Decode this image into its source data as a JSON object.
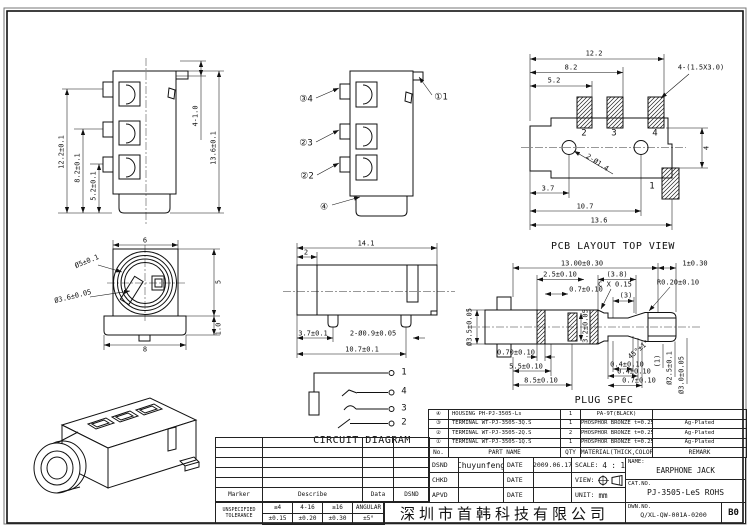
{
  "front_view": {
    "dim_a": "12.2±0.1",
    "dim_b": "8.2±0.1",
    "dim_c": "5.2±0.1",
    "dim_d": "4-1.0",
    "dim_e": "13.6±0.1"
  },
  "callout_view": {
    "c1": "③4",
    "c2": "②3",
    "c3": "②2",
    "c4": "④",
    "c5": "①1"
  },
  "pcb_layout": {
    "title": "PCB LAYOUT TOP VIEW",
    "dim_a": "12.2",
    "dim_b": "8.2",
    "dim_c": "5.2",
    "slot_note": "4-(1.5X3.0)",
    "hole_note": "2-Ø1.4",
    "dim_d": "4",
    "dim_e": "3.7",
    "dim_f": "10.7",
    "dim_g": "13.6",
    "pad_2": "2",
    "pad_3": "3",
    "pad_4": "4",
    "pad_1": "1"
  },
  "front_circle_view": {
    "dia_a": "Ø5±0.1",
    "dia_b": "Ø3.6±0.05",
    "dim_a": "6",
    "dim_b": "5",
    "dim_c": "8",
    "dim_d": "1.0"
  },
  "side_view": {
    "dim_a": "14.1",
    "dim_b": "2",
    "dim_c": "3.7±0.1",
    "pin_note": "2-Ø0.9±0.05",
    "dim_d": "10.7±0.1"
  },
  "plug_spec": {
    "title": "PLUG SPEC",
    "dim_a": "13.00±0.30",
    "dim_b": "1±0.30",
    "dim_c": "2.5±0.10",
    "dim_d": "(3.8)",
    "dim_e": "C X 0.15",
    "dim_f": "0.7±0.10",
    "dim_g": "(3)",
    "dim_h": "R0.20±0.10",
    "dia_a": "Ø3.5±0.05",
    "dim_i": "3.2±0.05",
    "dim_j": "0.70±0.10",
    "dim_k": "5.5±0.10",
    "dim_l": "8.5±0.10",
    "dim_m": "0.4±0.10",
    "dim_n": "0.4±0.10",
    "dim_o": "0.7±0.10",
    "angle": "45°±1°",
    "dim_p": "(1)",
    "dia_b": "Ø2.5±0.1",
    "dia_c": "Ø3.0±0.05"
  },
  "circuit": {
    "title": "CIRCUIT DIAGRAM",
    "t1": "1",
    "t4": "4",
    "t3": "3",
    "t2": "2"
  },
  "parts_table": {
    "headers": [
      "No.",
      "PART NAME",
      "QTY",
      "MATERIAL(THICK,COLOR)",
      "REMARK"
    ],
    "rows": [
      {
        "no": "④",
        "part": "HOUSING PH-PJ-3505-Ls",
        "qty": "1",
        "material": "PA-9T(BLACK)",
        "remark": ""
      },
      {
        "no": "③",
        "part": "TERMINAL WT-PJ-3505-3Q.S",
        "qty": "1",
        "material": "PHOSPHOR BRONZE t=0.25",
        "remark": "Ag-Plated"
      },
      {
        "no": "②",
        "part": "TERMINAL WT-PJ-3505-2Q.S",
        "qty": "2",
        "material": "PHOSPHOR BRONZE t=0.25",
        "remark": "Ag-Plated"
      },
      {
        "no": "①",
        "part": "TERMINAL WT-PJ-3505-1Q.S",
        "qty": "1",
        "material": "PHOSPHOR BRONZE t=0.25",
        "remark": "Ag-Plated"
      }
    ]
  },
  "title_block": {
    "dsnd_label": "DSND",
    "dsnd_value": "Chuyunfeng",
    "chkd_label": "CHKD",
    "apvd_label": "APVD",
    "date_label": "DATE",
    "date_value": "2009.06.17",
    "scale_label": "SCALE:",
    "scale_value": "4 : 1",
    "view_label": "VIEW:",
    "unit_label": "UNIT:",
    "unit_value": "mm",
    "name_label": "NAME:",
    "name_value": "EARPHONE JACK",
    "catno_label": "CAT.NO.",
    "catno_value": "PJ-3505-LeS ROHS",
    "dwnno_label": "DWN.NO.",
    "dwnno_value": "Q/XL-QW-001A-0200",
    "rev": "B0",
    "company": "深圳市首韩科技有限公司"
  },
  "revision_table": {
    "headers": [
      "Marker",
      "Describe",
      "Data",
      "DSND"
    ]
  },
  "tolerance_table": {
    "label": "UNSPECIFIED TOLERANCE",
    "cols": [
      "≤4",
      "4-16",
      "≥16",
      "ANGULAR"
    ],
    "vals": [
      "±0.15",
      "±0.20",
      "±0.30",
      "±5°"
    ]
  }
}
